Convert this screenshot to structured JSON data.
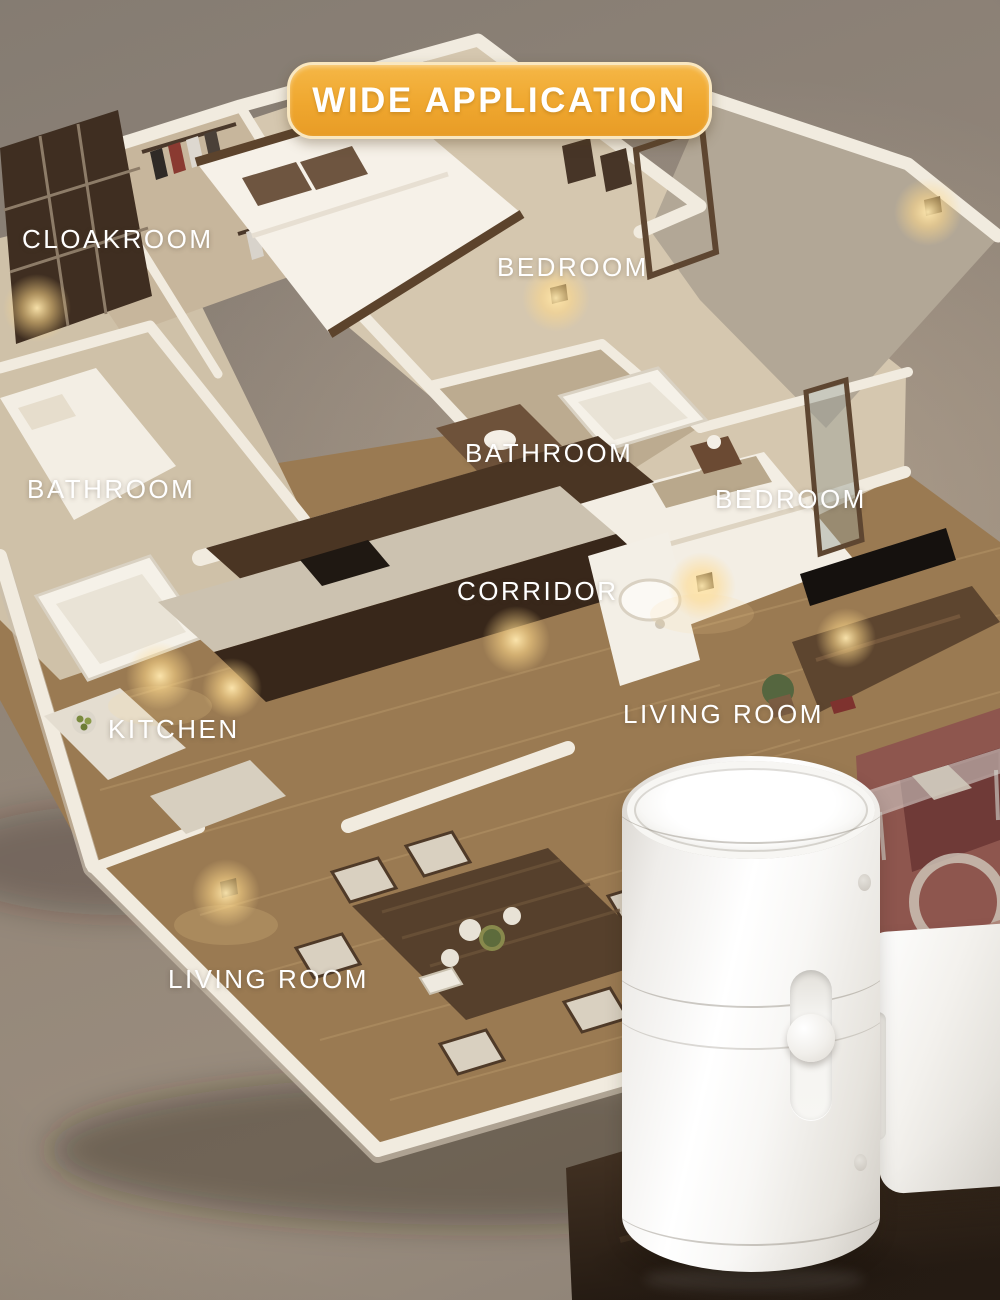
{
  "badge": {
    "label": "WIDE APPLICATION"
  },
  "rooms": [
    {
      "name": "cloakroom",
      "label": "CLOAKROOM"
    },
    {
      "name": "bedroom-top",
      "label": "BEDROOM"
    },
    {
      "name": "bathroom-center",
      "label": "BATHROOM"
    },
    {
      "name": "bathroom-left",
      "label": "BATHROOM"
    },
    {
      "name": "bedroom-right",
      "label": "BEDROOM"
    },
    {
      "name": "corridor",
      "label": "CORRIDOR"
    },
    {
      "name": "kitchen",
      "label": "KITCHEN"
    },
    {
      "name": "living-room-right",
      "label": "LIVING ROOM"
    },
    {
      "name": "living-room-bottom",
      "label": "LIVING ROOM"
    }
  ],
  "colors": {
    "badge_bg": "#f0a733",
    "badge_border": "#f9e7c0",
    "label_text": "#ffffff",
    "background": "#8f8478",
    "walls": "#f1ebdf",
    "carpet": "#d5c7af",
    "wood_floor": "#9a7a52",
    "device_body": "#f6f5f2",
    "warm_light": "#ffd98a"
  }
}
